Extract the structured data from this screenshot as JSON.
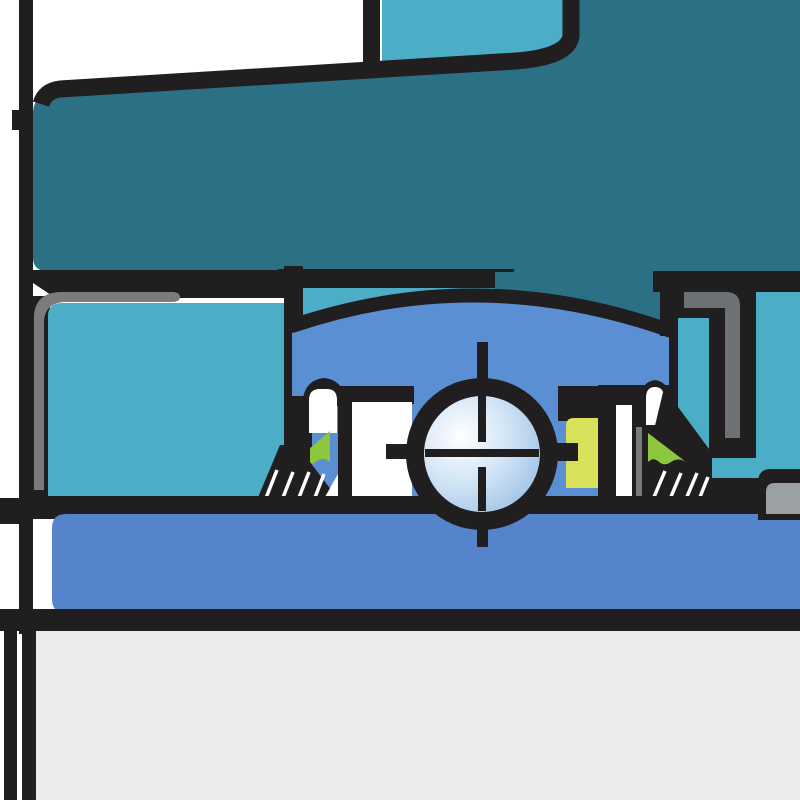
{
  "figure": {
    "title": "Ball bearing unit cross-section (zoomed technical illustration)",
    "type": "technical-illustration",
    "text_visible": false
  },
  "palette": {
    "ink": "#211e1f",
    "white": "#ffffff",
    "paper-gray": "#e9ebec",
    "housing-teal": "#2b7085",
    "cover-teal": "#4badc6",
    "outer-ring-blue": "#5b8fd3",
    "shaft-blue": "#5584ca",
    "seal-green": "#8dc63f",
    "insert-yellow": "#d9e15b",
    "metal-gray-dark": "#6e7174",
    "metal-gray": "#797b7d",
    "metal-gray-light": "#9ba0a3",
    "ball-highlight": "#ffffff",
    "ball-mid": "#cfe3f5",
    "ball-shade": "#88b2dd",
    "bottom-area-gray": "#e9ebec"
  },
  "parts": [
    {
      "name": "housing",
      "color_ref": "housing-teal",
      "desc": "cast housing body, upper dark teal mass"
    },
    {
      "name": "end-cover",
      "color_ref": "cover-teal",
      "desc": "light teal cover / seat pieces left, top and right"
    },
    {
      "name": "outer-ring",
      "color_ref": "outer-ring-blue",
      "desc": "bearing outer ring with spherical top arc"
    },
    {
      "name": "inner-ring",
      "color_ref": "white",
      "desc": "white inner ring sections beside ball"
    },
    {
      "name": "ball",
      "color_ref": "ball-mid",
      "desc": "rolling ball with centerline cross marks"
    },
    {
      "name": "seal-lip-left",
      "color_ref": "seal-green",
      "desc": "green seal lip triangle, left"
    },
    {
      "name": "seal-lip-right",
      "color_ref": "seal-green",
      "desc": "green seal lip triangle, right"
    },
    {
      "name": "seal-insert",
      "color_ref": "insert-yellow",
      "desc": "yellow-green seal insert block"
    },
    {
      "name": "locking-element",
      "color_ref": "metal-gray-dark",
      "desc": "gray hook-shaped locking element, right"
    },
    {
      "name": "gasket-strip",
      "color_ref": "metal-gray",
      "desc": "thin gray L-strip, left"
    },
    {
      "name": "shaft-sleeve",
      "color_ref": "shaft-blue",
      "desc": "blue shaft band below bearing"
    },
    {
      "name": "shaft-body",
      "color_ref": "bottom-area-gray",
      "desc": "light gray area at bottom"
    },
    {
      "name": "hatching",
      "color_ref": "white",
      "desc": "white diagonal section hatching on black seal bases"
    }
  ]
}
